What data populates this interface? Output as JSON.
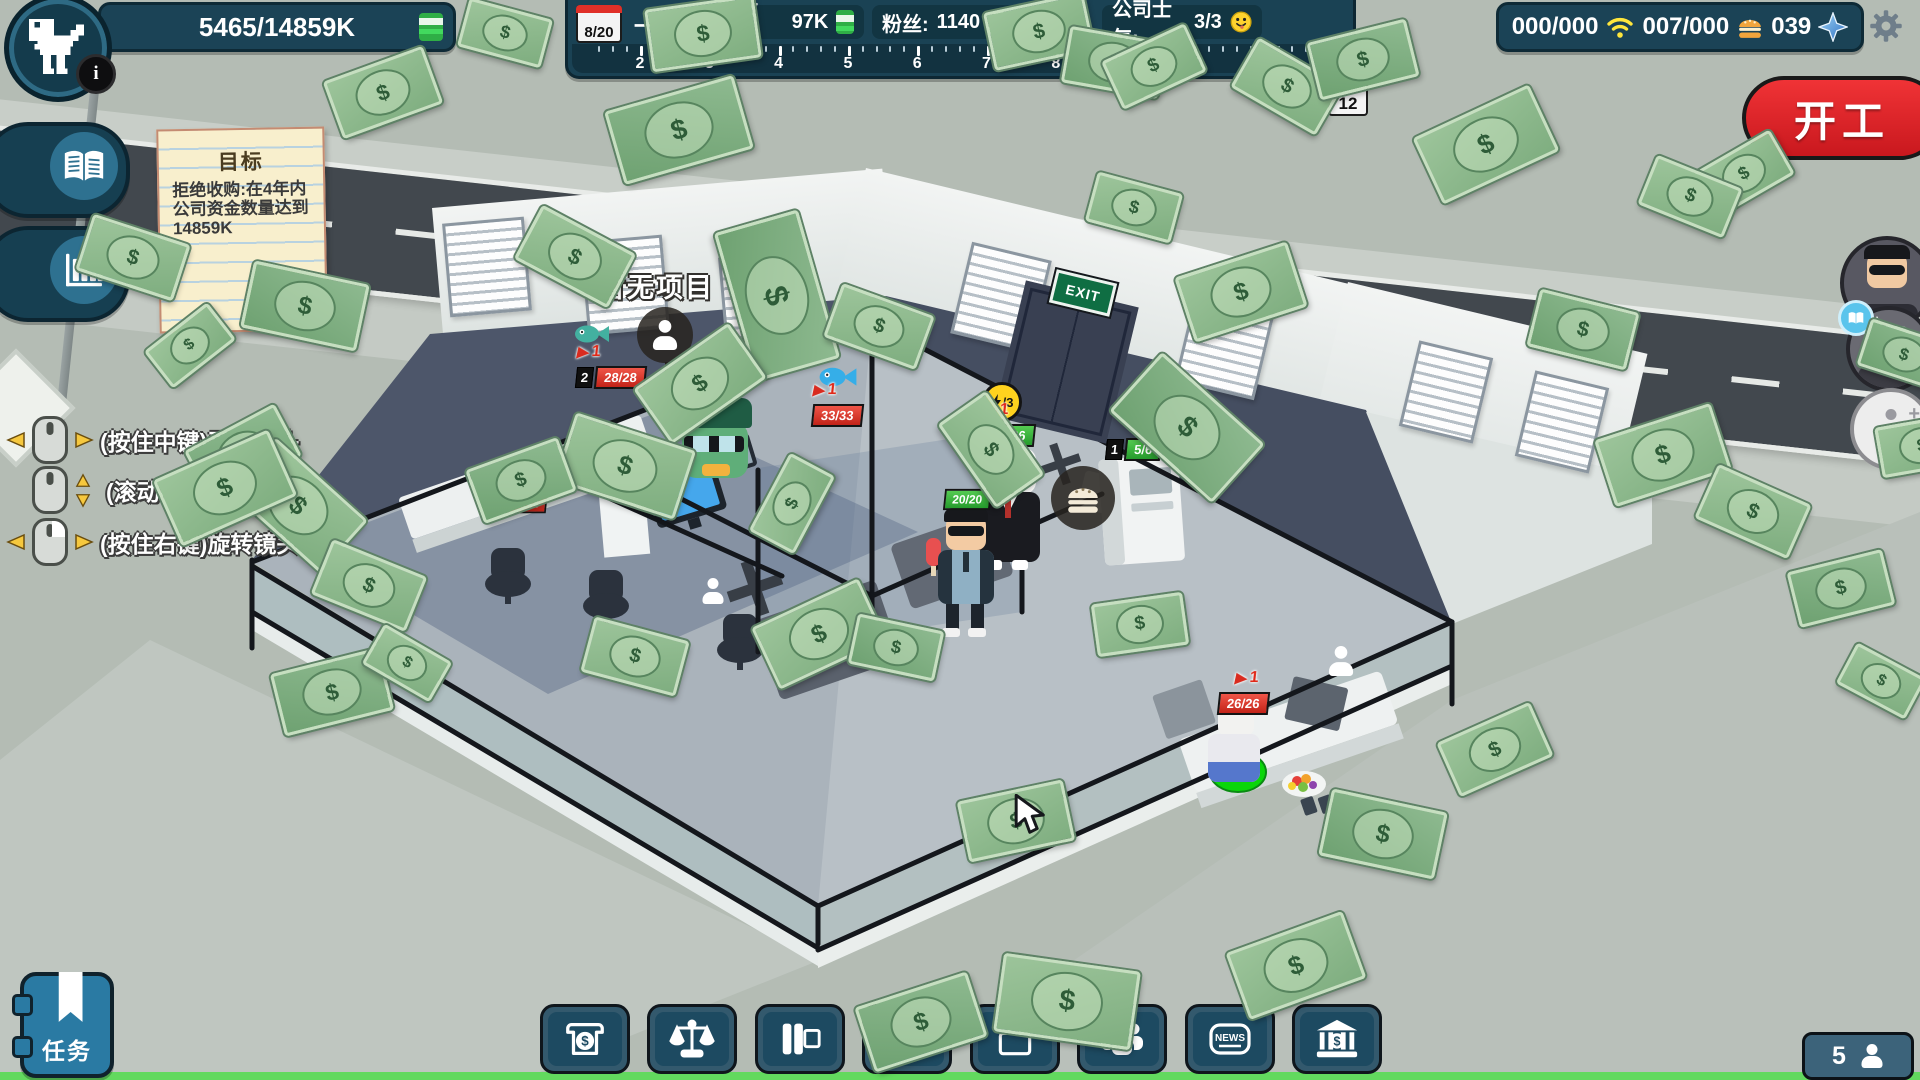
{
  "hud": {
    "funds": "5465/14859K",
    "info_badge": "i",
    "start_button": "开工",
    "task_button": "任务",
    "staff_count": "5",
    "accent_colors": {
      "panel_teal": "#1b4356",
      "button_red": "#e02128",
      "money_green": "#42d95e"
    }
  },
  "top_bar": {
    "date": "8/20",
    "month": "一月",
    "tax_label": "已缴税:",
    "tax_value": "97K",
    "fans_label": "粉丝:",
    "fans_value": "1140",
    "morale_label": "公司士气:",
    "morale_value": "3/3",
    "ruler_numbers": [
      "2",
      "3",
      "4",
      "5",
      "6",
      "7",
      "8",
      "9",
      "10",
      "11",
      "12"
    ],
    "ruler_end_day": "12"
  },
  "resources": {
    "bandwidth": "000/000",
    "food": "007/000",
    "gems": "039"
  },
  "goal_note": {
    "title": "目标",
    "text": "拒绝收购:在4年内公司资金数量达到14859K"
  },
  "controls": {
    "items": [
      {
        "icon": "mouse-middle-drag",
        "text": "(按住中键)平移镜头"
      },
      {
        "icon": "mouse-scroll",
        "text": "(滚动中键)缩放镜头"
      },
      {
        "icon": "mouse-right-drag",
        "text": "(按住右键)旋转镜头"
      }
    ]
  },
  "scene": {
    "no_project_label": "暂无项目",
    "exit_sign": "EXIT",
    "energy_badge": "/3",
    "status_badges": [
      {
        "level": "2",
        "value": "28/28",
        "boost": "1",
        "type": "hp"
      },
      {
        "level": "",
        "value": "33/33",
        "boost": "1",
        "type": "hp"
      },
      {
        "level": "",
        "value": "26/26",
        "boost": "1",
        "type": "stamina"
      },
      {
        "level": "1",
        "value": "5/6",
        "boost": "",
        "type": "stamina"
      },
      {
        "level": "",
        "value": "20/20",
        "boost": "",
        "type": "stamina"
      },
      {
        "level": "2",
        "value": "24/24",
        "boost": "",
        "type": "hp"
      },
      {
        "level": "",
        "value": "26/26",
        "boost": "1",
        "type": "hp"
      }
    ]
  },
  "toolbar": {
    "news_label": "NEWS",
    "buttons": [
      "finance",
      "legal",
      "projects",
      "build",
      "storage",
      "staff",
      "news",
      "bank"
    ]
  }
}
